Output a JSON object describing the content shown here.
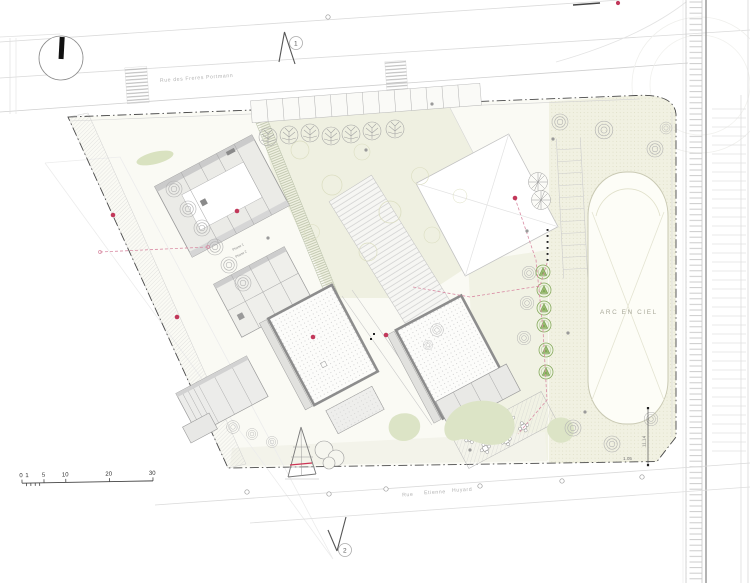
{
  "plan": {
    "title": "architectural site plan",
    "streets": {
      "top_label": "Rue des Freres Portmann",
      "bottom_words": [
        "Rue",
        "Etienne",
        "Huyard"
      ]
    },
    "labels": {
      "stadium": "ARC EN CIEL",
      "phase_1": "Phase 1",
      "phase_2": "Phase 2",
      "dim_vertical": "11.14",
      "dim_horizontal": "1.05"
    },
    "section_markers": {
      "marker_1": "1",
      "marker_2": "2"
    },
    "scale_bar": {
      "ticks": [
        "0",
        "1",
        "5",
        "10",
        "20",
        "30"
      ]
    },
    "icons": {
      "north": "north-indicator-icon",
      "section": "section-cut-icon",
      "ring_tree": "ring-tree-icon",
      "conifer": "conifer-tree-icon",
      "branch_tree": "branch-tree-icon",
      "manhole": "manhole-icon",
      "table": "table-and-chairs-icon"
    },
    "colors": {
      "accent_red": "#c2385a",
      "pink_dash": "#d98ca4",
      "conifer_green": "#8fb368",
      "lawn_green": "#dce4c6",
      "beige_zone": "#f1f1e2",
      "cream_zone": "#eff0e1",
      "boundary": "#4a4a4a",
      "building_fill": "#ebebe7",
      "needle_black": "#111111"
    }
  }
}
